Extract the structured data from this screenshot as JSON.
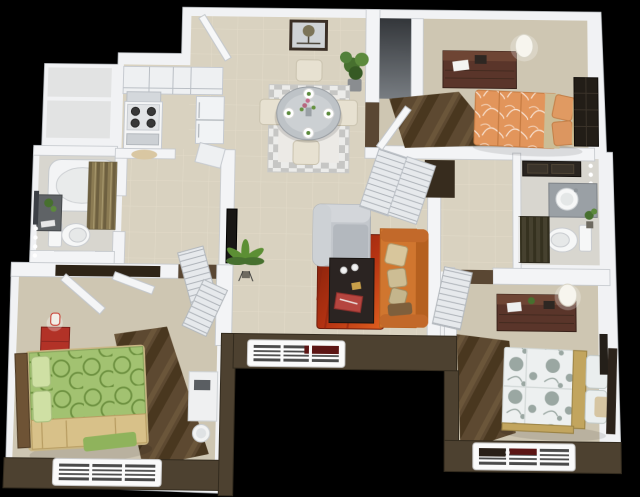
{
  "scene": {
    "type": "3d-apartment-floor-plan",
    "view": "isometric-top-down-render",
    "background": "#000000",
    "visible_text": "none",
    "summary": {
      "bedrooms": 3,
      "bathrooms": 2,
      "windows": 3
    }
  },
  "palette": {
    "background": "#000000",
    "wall": "#f1f2f4",
    "wall_edge": "#c3c7cc",
    "exterior_wall": "#4d4130",
    "exterior_wall_dark": "#332b1e",
    "floor_main": "#d9d2c0",
    "floor_bedroom": "#cec6b2",
    "floor_bath": "#d8d6cf",
    "carpet_brown": "#5d4931",
    "rug_red": "#b53312",
    "rug_orange": "#e0601f",
    "dining_rug_gray": "#c6c6c4",
    "sofa_orange": "#d0762f",
    "armchair_gray": "#c3c7cc",
    "coffee_table": "#2b2422",
    "bed_green": "#a2c271",
    "blanket_tan": "#d8c189",
    "bed_orange": "#e2955b",
    "bed_white": "#edf0f0",
    "bed_white_pattern": "#9aa7a2",
    "wood_dresser": "#5a352a",
    "nightstand_red": "#b23227",
    "headboard_gold": "#c2a55e",
    "lamp_white": "#f7f5ee",
    "plant_green": "#47702f",
    "curtain_olive": "#8b7b53",
    "shower_dark": "#46412f",
    "fixture_white": "#f6f7f7",
    "tv_black": "#191715",
    "window_blind_red": "#5c1514",
    "closet_dark": "#372c1e"
  },
  "rooms": [
    {
      "name": "kitchen",
      "furniture": [
        "upper-cabinets",
        "range-hood",
        "stove-four-burners",
        "refrigerator",
        "counter",
        "floor-mat"
      ]
    },
    {
      "name": "foyer",
      "furniture": [
        "entry-door",
        "framed-tree-picture",
        "potted-plant"
      ]
    },
    {
      "name": "dining-area",
      "furniture": [
        "checkered-area-rug",
        "round-glass-table",
        "four-place-settings",
        "flower-centerpiece",
        "four-cream-chairs"
      ]
    },
    {
      "name": "living-room",
      "furniture": [
        "orange-sofa-with-pillows",
        "gray-armchair",
        "dark-coffee-table",
        "red-orange-rug",
        "wall-tv",
        "palm-plant-on-stand"
      ]
    },
    {
      "name": "hallway",
      "furniture": [
        "slanted-closet-doors",
        "louvered-bifold-doors"
      ]
    },
    {
      "name": "bathroom-left",
      "furniture": [
        "bathtub",
        "olive-shower-curtain",
        "toilet",
        "dark-vanity-with-plant",
        "mirror",
        "vanity-lights"
      ]
    },
    {
      "name": "bedroom-top-right",
      "furniture": [
        "orange-swirl-bed",
        "tan-pillows",
        "dark-wood-dresser",
        "white-table-lamp",
        "dark-mirrored-headboard-closet",
        "walk-in-closet",
        "brown-carpet-runner",
        "door"
      ]
    },
    {
      "name": "bathroom-right",
      "furniture": [
        "gray-vanity-with-round-sink",
        "toilet",
        "dark-shower-curtain",
        "dark-mirror",
        "vanity-lights",
        "small-plant"
      ]
    },
    {
      "name": "bedroom-bottom-right",
      "furniture": [
        "white-gray-dot-bed",
        "gold-bed-rails",
        "dark-wood-dresser",
        "white-table-lamp",
        "louvered-door",
        "brown-carpet-runner",
        "wall-mirror",
        "window"
      ]
    },
    {
      "name": "bedroom-bottom-left",
      "furniture": [
        "green-circle-pattern-bed",
        "tan-blanket",
        "red-nightstand",
        "red-white-lamp",
        "closet-doors",
        "vanity-desk",
        "round-stool",
        "brown-carpet-runner",
        "window"
      ]
    }
  ],
  "windows": [
    {
      "location": "bottom-left-bedroom-south-wall"
    },
    {
      "location": "center-patio-notch-wall",
      "detail": "dark-red-blind-section"
    },
    {
      "location": "bottom-right-bedroom-south-wall",
      "detail": "dark-and-red-blind-sections"
    }
  ]
}
